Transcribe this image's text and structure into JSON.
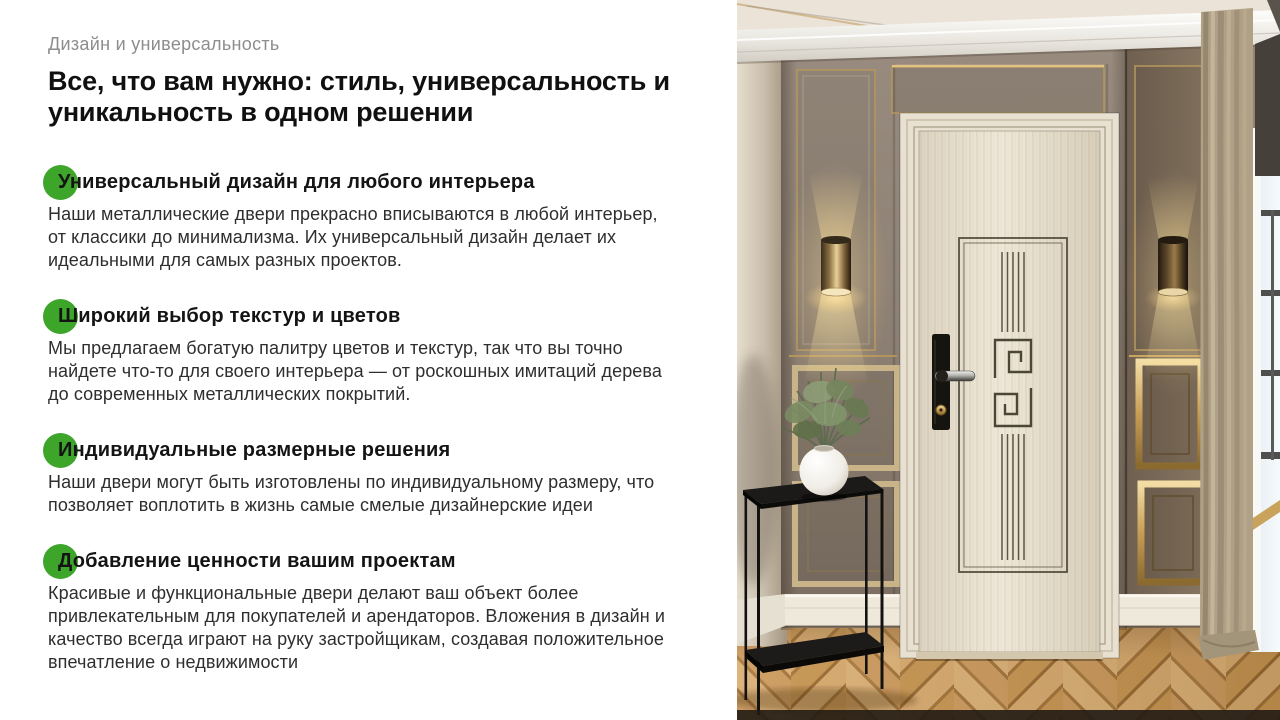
{
  "slide": {
    "eyebrow": "Дизайн и универсальность",
    "title": "Все, что вам нужно: стиль, универсальность и уникальность в одном решении",
    "bullet_color": "#3ea52b",
    "features": [
      {
        "title": "Универсальный дизайн для любого интерьера",
        "body": "Наши металлические двери прекрасно вписываются в любой интерьер, от классики до минимализма. Их универсальный дизайн делает их идеальными для самых разных проектов."
      },
      {
        "title": "Широкий выбор текстур и цветов",
        "body": "Мы предлагаем богатую палитру цветов и текстур, так что вы точно найдете что-то для своего интерьера — от роскошных имитаций дерева до современных металлических покрытий."
      },
      {
        "title": "Индивидуальные размерные решения",
        "body": "Наши двери могут быть изготовлены по индивидуальному размеру, что позволяет воплотить в жизнь самые смелые дизайнерские идеи"
      },
      {
        "title": "Добавление ценности вашим проектам",
        "body": "Красивые и функциональные двери делают ваш объект более привлекательным для покупателей и арендаторов. Вложения в дизайн и качество всегда играют на руку застройщикам, создавая положительное впечатление о недвижимости"
      }
    ]
  }
}
